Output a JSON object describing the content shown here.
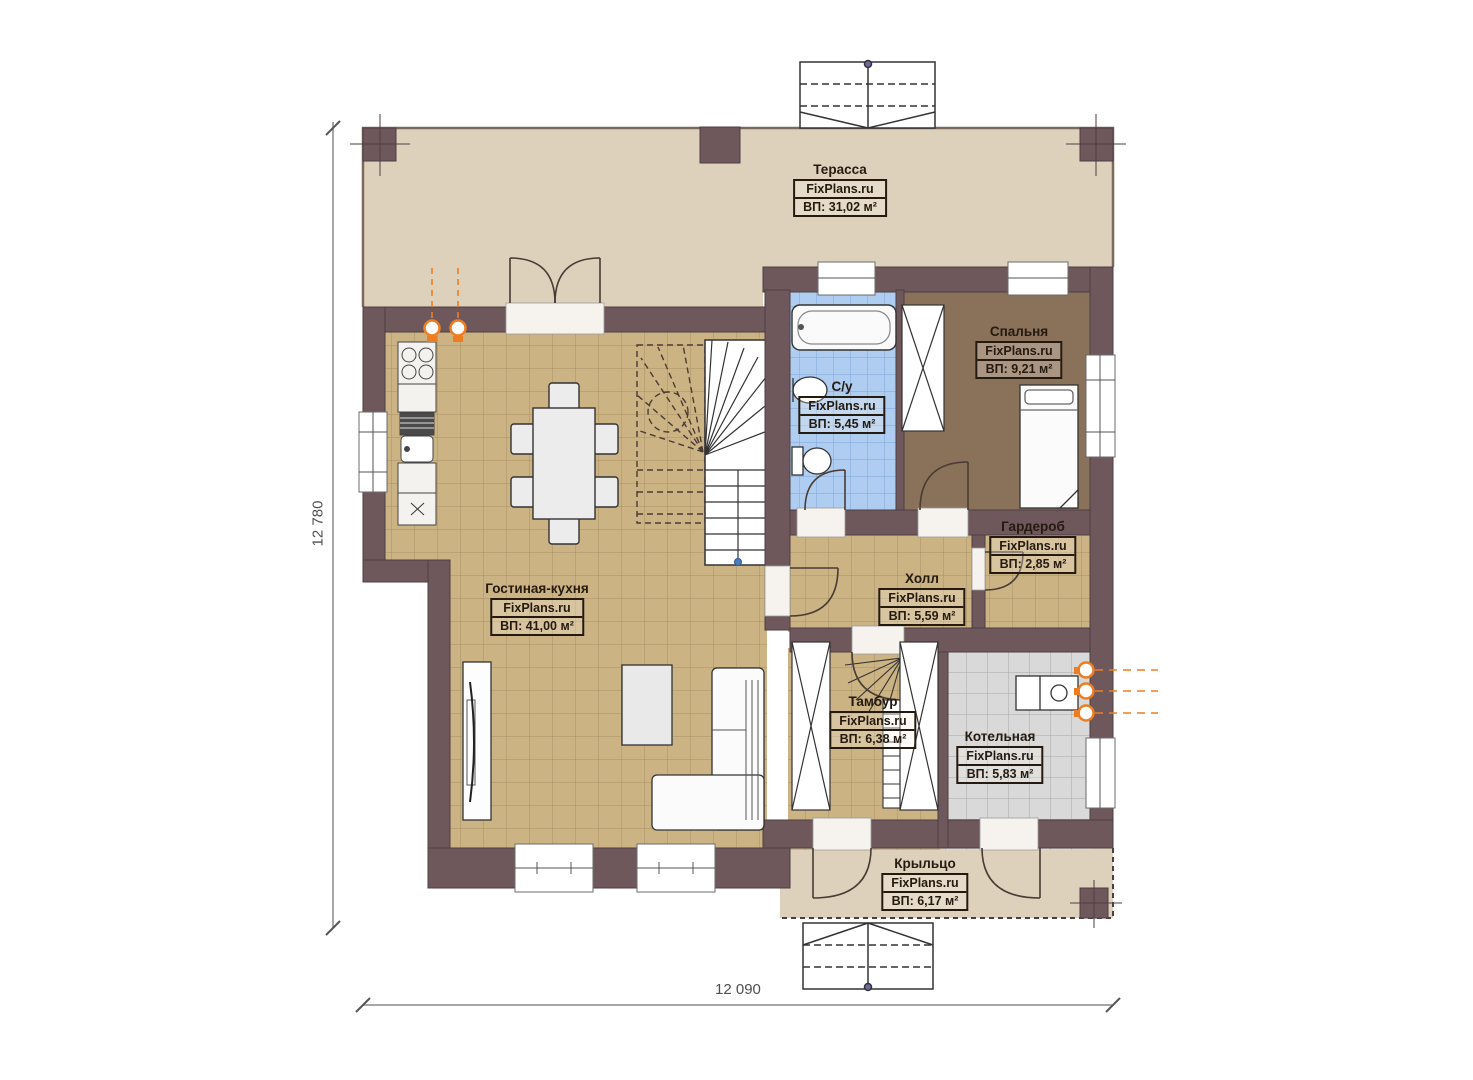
{
  "plan": {
    "dimension_left": "12 780",
    "dimension_bottom": "12 090"
  },
  "rooms": [
    {
      "name": "Терасса",
      "watermark": "FixPlans.ru",
      "area": "ВП: 31,02 м²"
    },
    {
      "name": "Спальня",
      "watermark": "FixPlans.ru",
      "area": "ВП: 9,21 м²"
    },
    {
      "name": "С/у",
      "watermark": "FixPlans.ru",
      "area": "ВП: 5,45 м²"
    },
    {
      "name": "Гардероб",
      "watermark": "FixPlans.ru",
      "area": "ВП: 2,85 м²"
    },
    {
      "name": "Холл",
      "watermark": "FixPlans.ru",
      "area": "ВП: 5,59 м²"
    },
    {
      "name": "Гостиная-кухня",
      "watermark": "FixPlans.ru",
      "area": "ВП: 41,00 м²"
    },
    {
      "name": "Тамбур",
      "watermark": "FixPlans.ru",
      "area": "ВП: 6,38 м²"
    },
    {
      "name": "Котельная",
      "watermark": "FixPlans.ru",
      "area": "ВП: 5,83 м²"
    },
    {
      "name": "Крыльцо",
      "watermark": "FixPlans.ru",
      "area": "ВП: 6,17 м²"
    }
  ],
  "colors": {
    "wall": "#6f585c",
    "terrace_floor": "#ddd1bc",
    "tile_tan": "#cbb384",
    "tile_blue": "#aecdf0",
    "tile_gray": "#d9d9d9",
    "bedroom_floor": "#8a7159",
    "accent_orange": "#ee7d22"
  }
}
